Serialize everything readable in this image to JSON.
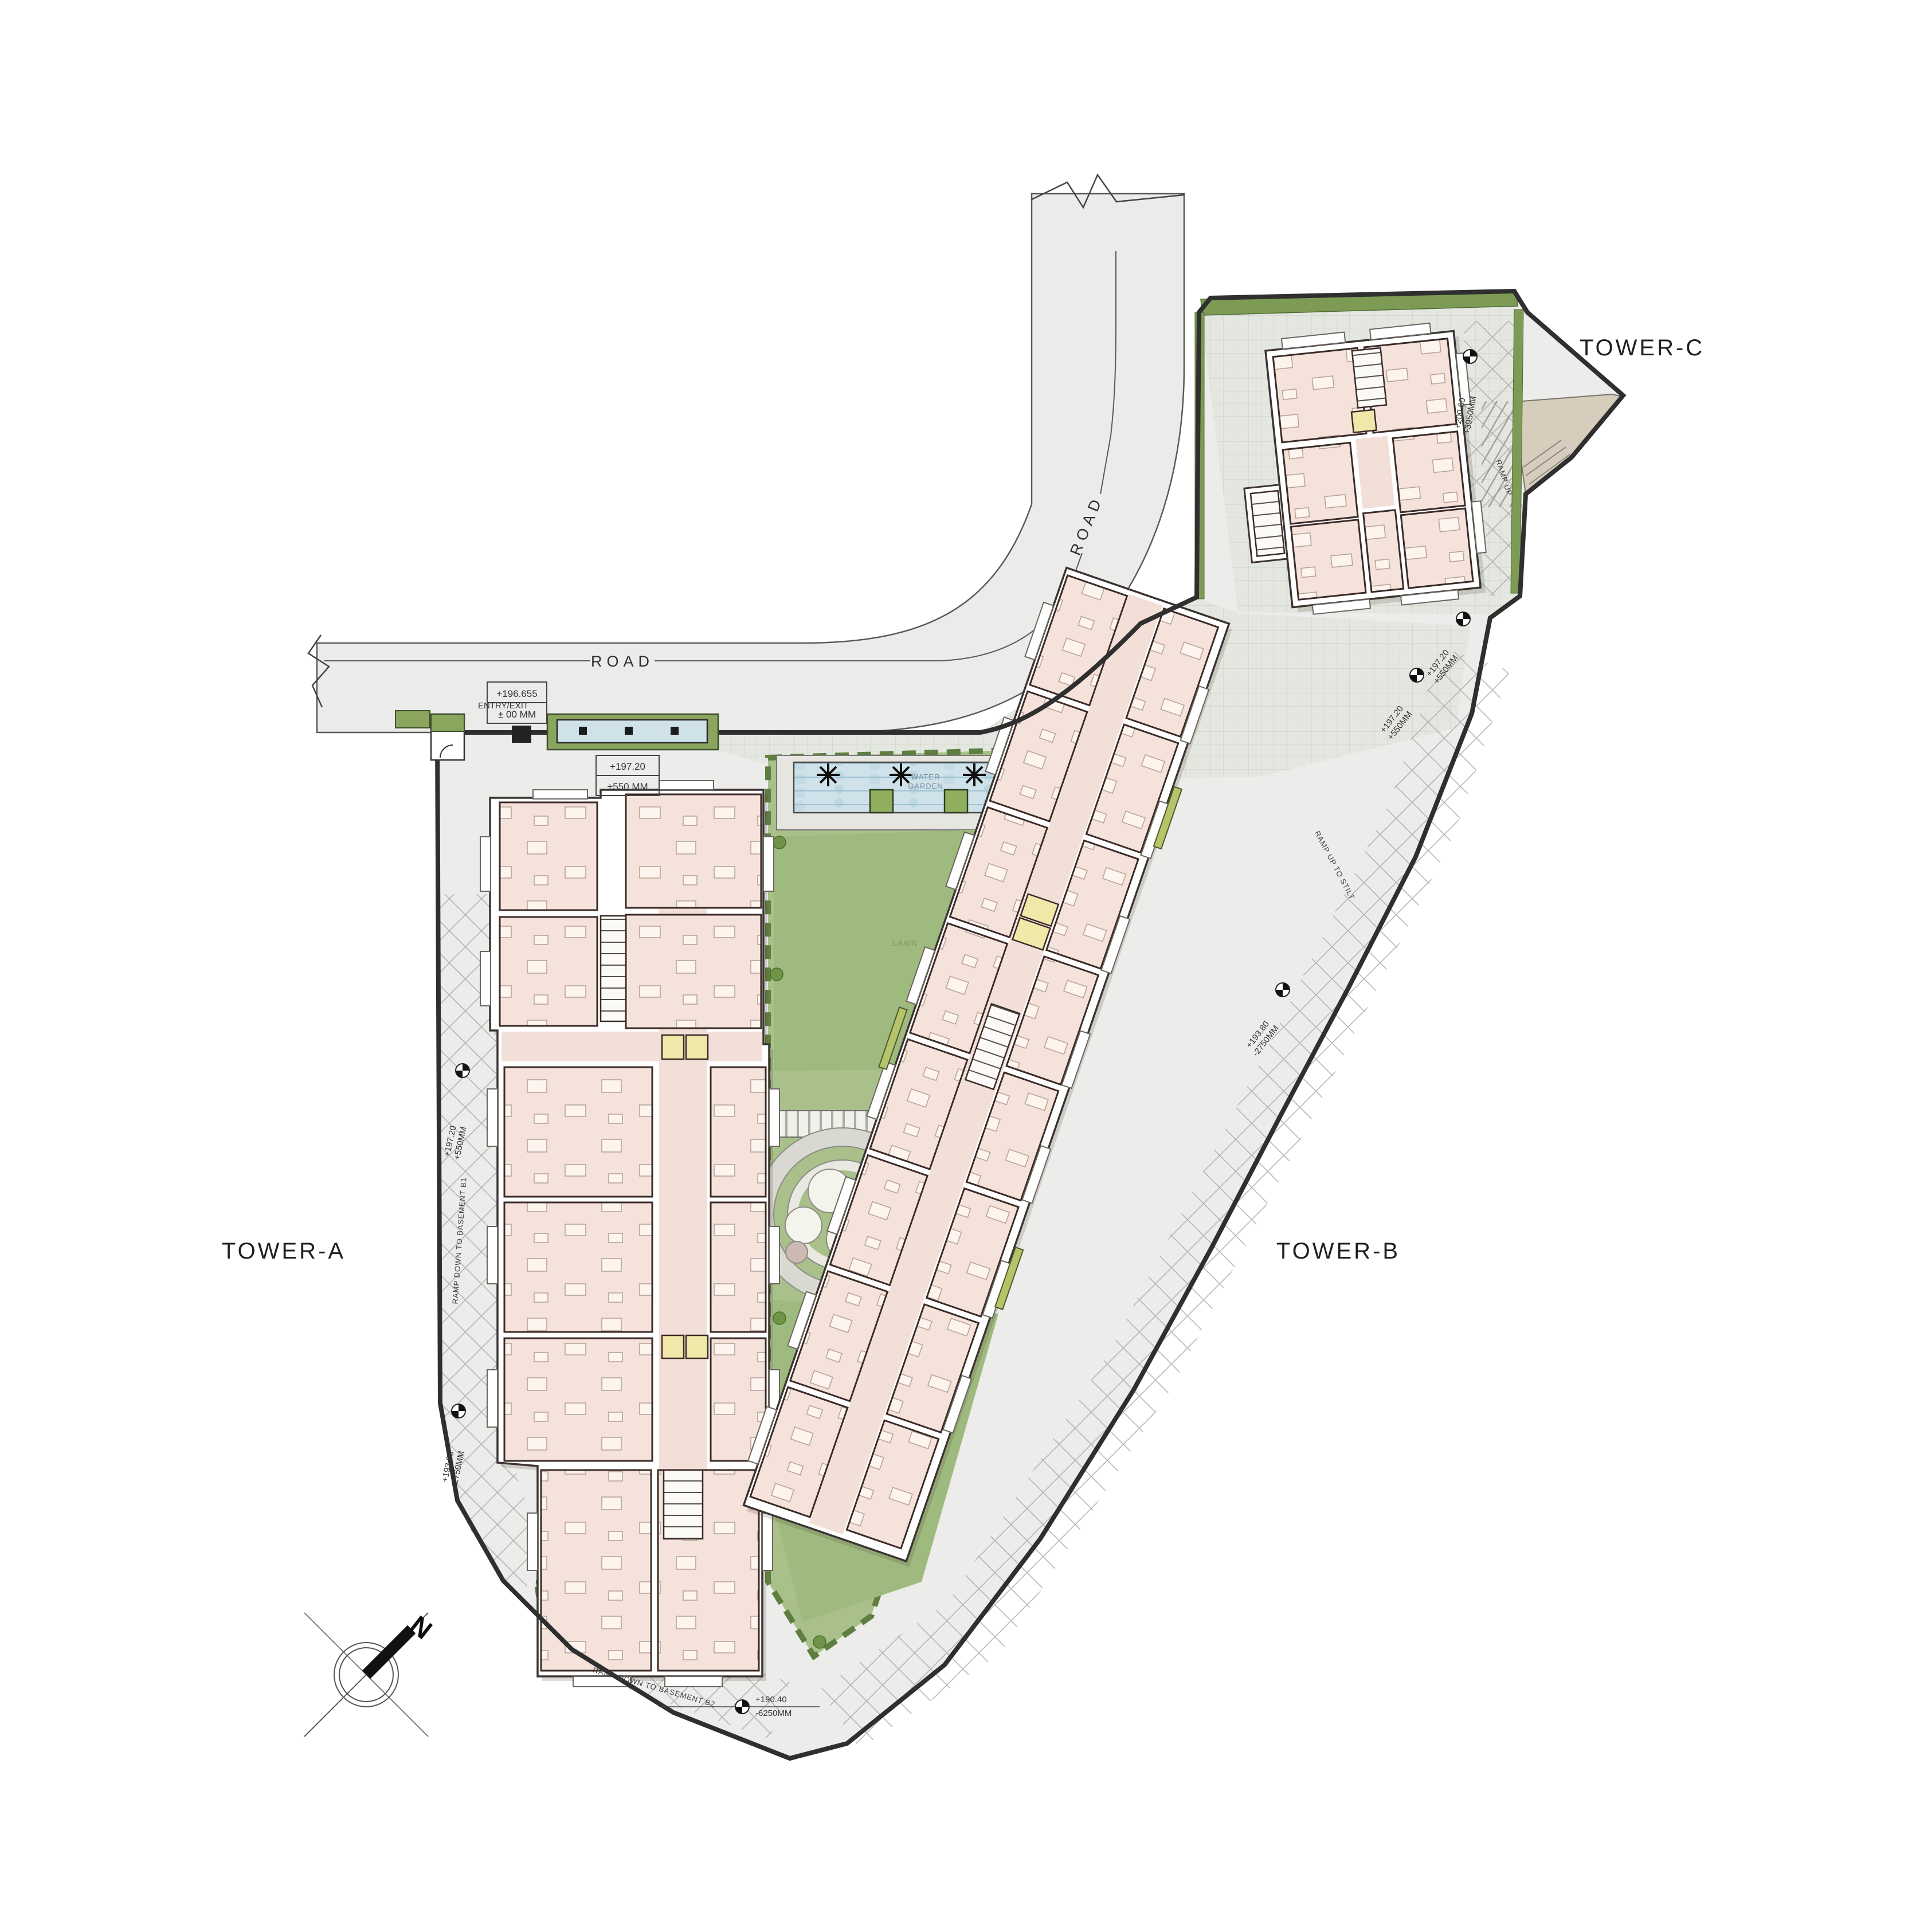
{
  "drawing": {
    "type": "residential site plan / ground floor layout",
    "towers": {
      "a": "TOWER-A",
      "b": "TOWER-B",
      "c": "TOWER-C"
    },
    "roads": {
      "horizontal": "ROAD",
      "vertical": "ROAD"
    },
    "entry": {
      "label": "ENTRY/EXIT"
    },
    "level_boxes": {
      "road": {
        "l1": "+196.655",
        "l2": "± 00 MM"
      },
      "plaza": {
        "l1": "+197.20",
        "l2": "+550 MM"
      }
    },
    "level_markers": {
      "left_ramp": {
        "l1": "+197.20",
        "l2": "+550MM"
      },
      "left_low": {
        "l1": "+193.80",
        "l2": "-2750MM"
      },
      "bottom": {
        "l1": "+190.40",
        "l2": "-6250MM"
      },
      "right_1": {
        "l1": "+197.20",
        "l2": "+550MM"
      },
      "right_2": {
        "l1": "+197.20",
        "l2": "+550MM"
      },
      "right_mid": {
        "l1": "+193.80",
        "l2": "-2750MM"
      },
      "tower_c_drive": {
        "l1": "+200.60",
        "l2": "+3950MM"
      }
    },
    "ramps": {
      "b1": "RAMP DOWN TO BASEMENT B1",
      "b2": "RAMP DOWN TO BASEMENT B2",
      "stilt": "RAMP UP TO STILT",
      "up": "RAMP UP"
    },
    "garden": {
      "water_garden_1": "WATER",
      "water_garden_2": "GARDEN",
      "lawn_upper": "LAWN",
      "lawn_lower": "LAWN"
    },
    "compass": {
      "north": "N"
    },
    "colors": {
      "road": "#ebebe9",
      "hardscape": "#ececea",
      "plaza_grid": "#e3e7df",
      "garden": "#a9c08b",
      "lawn": "#9fba7e",
      "hedge": "#5f7f40",
      "water": "#cfe2ea",
      "building_wall": "#3c3432",
      "room": "#f5e2da",
      "lift": "#f0e8a8",
      "tan_area": "#d6cdbd",
      "boundary": "#2f2f2f"
    }
  }
}
